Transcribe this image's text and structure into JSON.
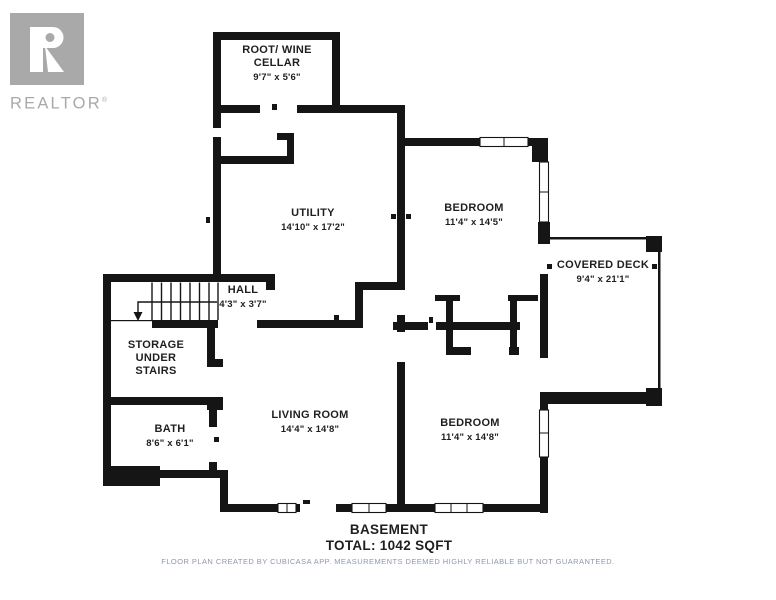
{
  "branding": {
    "logo_text": "REALTOR",
    "registered_mark": "®"
  },
  "rooms": {
    "root_cellar": {
      "name": "ROOT/ WINE\nCELLAR",
      "dims": "9'7\" x 5'6\""
    },
    "utility": {
      "name": "UTILITY",
      "dims": "14'10\" x 17'2\""
    },
    "bedroom_top": {
      "name": "BEDROOM",
      "dims": "11'4\" x 14'5\""
    },
    "covered_deck": {
      "name": "COVERED DECK",
      "dims": "9'4\" x 21'1\""
    },
    "hall": {
      "name": "HALL",
      "dims": "4'3\" x 3'7\""
    },
    "storage": {
      "name": "STORAGE\nUNDER\nSTAIRS"
    },
    "bath": {
      "name": "BATH",
      "dims": "8'6\" x 6'1\""
    },
    "living_room": {
      "name": "LIVING ROOM",
      "dims": "14'4\" x 14'8\""
    },
    "bedroom_bottom": {
      "name": "BEDROOM",
      "dims": "11'4\" x 14'8\""
    }
  },
  "summary": {
    "floor_name": "BASEMENT",
    "total": "TOTAL: 1042 SQFT"
  },
  "footer": {
    "disclaimer": "FLOOR PLAN CREATED BY CUBICASA APP. MEASUREMENTS DEEMED HIGHLY RELIABLE BUT NOT GUARANTEED."
  },
  "theme": {
    "wall_color": "#151515",
    "text_color": "#1f1f1f",
    "logo_color": "#a9a9a9",
    "footer_color": "#8f98a8",
    "background": "#ffffff"
  }
}
